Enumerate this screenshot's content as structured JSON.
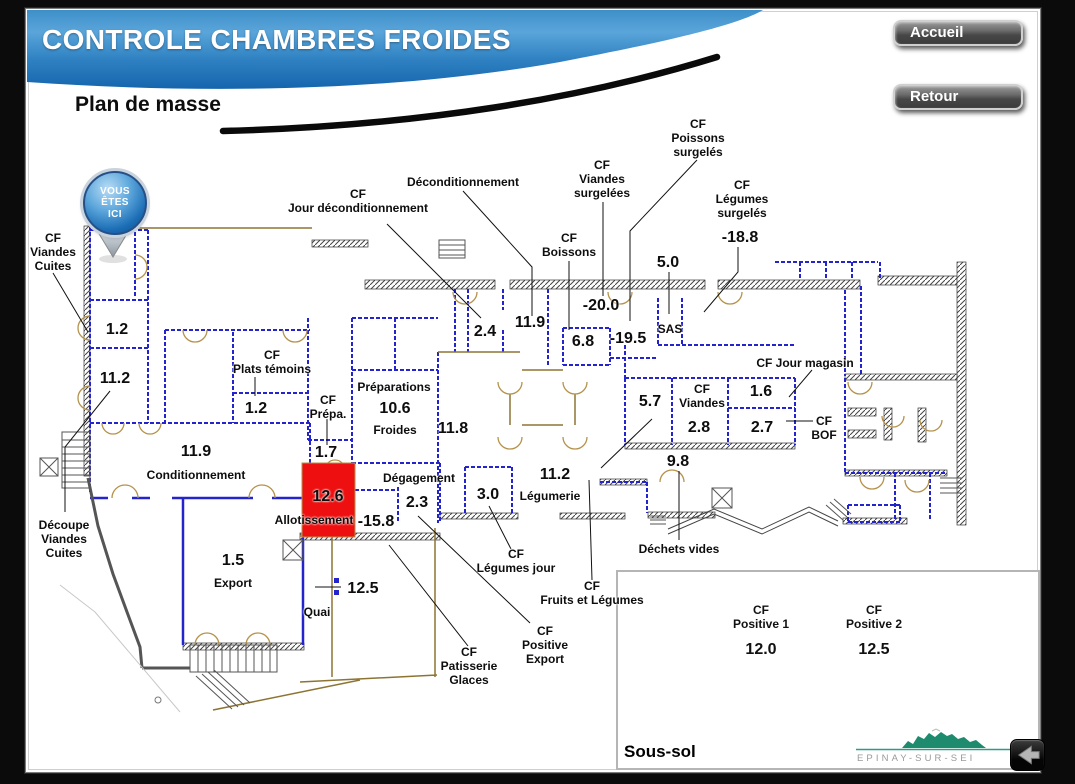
{
  "header": {
    "title": "CONTROLE CHAMBRES FROIDES",
    "subtitle": "Plan de masse"
  },
  "nav": {
    "accueil": "Accueil",
    "retour": "Retour"
  },
  "marker": {
    "lines": [
      "VOUS",
      "ÊTES",
      "ICI"
    ]
  },
  "plan": {
    "labels": [
      {
        "id": "cf-viandes-cuites",
        "kind": "name",
        "x": 53,
        "y": 252,
        "lines": [
          "CF",
          "Viandes",
          "Cuites"
        ]
      },
      {
        "id": "val-1-2-a",
        "kind": "value",
        "x": 117,
        "y": 330,
        "lines": [
          "1.2"
        ]
      },
      {
        "id": "val-11-2-a",
        "kind": "value",
        "x": 115,
        "y": 379,
        "lines": [
          "11.2"
        ]
      },
      {
        "id": "val-11-9-a",
        "kind": "value",
        "x": 196,
        "y": 452,
        "lines": [
          "11.9"
        ]
      },
      {
        "id": "conditionnement",
        "kind": "name",
        "x": 196,
        "y": 475,
        "lines": [
          "Conditionnement"
        ]
      },
      {
        "id": "cf-plats-temoins",
        "kind": "name",
        "x": 272,
        "y": 362,
        "lines": [
          "CF",
          "Plats témoins"
        ]
      },
      {
        "id": "val-1-2-b",
        "kind": "value",
        "x": 256,
        "y": 409,
        "lines": [
          "1.2"
        ]
      },
      {
        "id": "cf-prepa",
        "kind": "name",
        "x": 328,
        "y": 407,
        "lines": [
          "CF",
          "Prépa."
        ]
      },
      {
        "id": "val-1-7",
        "kind": "value",
        "x": 326,
        "y": 453,
        "lines": [
          "1.7"
        ]
      },
      {
        "id": "val-12-6",
        "kind": "value",
        "x": 328,
        "y": 497,
        "lines": [
          "12.6"
        ]
      },
      {
        "id": "allotissement",
        "kind": "name",
        "x": 314,
        "y": 520,
        "lines": [
          "Allotissement"
        ]
      },
      {
        "id": "preparations",
        "kind": "name",
        "x": 394,
        "y": 387,
        "lines": [
          "Préparations"
        ]
      },
      {
        "id": "val-10-6",
        "kind": "value",
        "x": 395,
        "y": 409,
        "lines": [
          "10.6"
        ]
      },
      {
        "id": "froides",
        "kind": "name",
        "x": 395,
        "y": 430,
        "lines": [
          "Froides"
        ]
      },
      {
        "id": "val-11-8",
        "kind": "value",
        "x": 453,
        "y": 429,
        "lines": [
          "11.8"
        ]
      },
      {
        "id": "degagement",
        "kind": "name",
        "x": 419,
        "y": 478,
        "lines": [
          "Dégagement"
        ]
      },
      {
        "id": "val-2-3",
        "kind": "value",
        "x": 417,
        "y": 503,
        "lines": [
          "2.3"
        ]
      },
      {
        "id": "val-neg-15-8",
        "kind": "value",
        "x": 376,
        "y": 522,
        "lines": [
          "-15.8"
        ]
      },
      {
        "id": "val-3-0",
        "kind": "value",
        "x": 488,
        "y": 495,
        "lines": [
          "3.0"
        ]
      },
      {
        "id": "val-11-2-b",
        "kind": "value",
        "x": 555,
        "y": 475,
        "lines": [
          "11.2"
        ]
      },
      {
        "id": "legumerie",
        "kind": "name",
        "x": 550,
        "y": 496,
        "lines": [
          "Légumerie"
        ]
      },
      {
        "id": "cf-legumes-jour",
        "kind": "name",
        "x": 516,
        "y": 561,
        "lines": [
          "CF",
          "Légumes jour"
        ]
      },
      {
        "id": "cf-fruits-et-legumes",
        "kind": "name",
        "x": 592,
        "y": 593,
        "lines": [
          "CF",
          "Fruits et Légumes"
        ]
      },
      {
        "id": "cf-positive-export",
        "kind": "name",
        "x": 545,
        "y": 645,
        "lines": [
          "CF",
          "Positive",
          "Export"
        ]
      },
      {
        "id": "cf-patisserie-glaces",
        "kind": "name",
        "x": 469,
        "y": 666,
        "lines": [
          "CF",
          "Patisserie",
          "Glaces"
        ]
      },
      {
        "id": "val-12-5",
        "kind": "value",
        "x": 363,
        "y": 589,
        "lines": [
          "12.5"
        ]
      },
      {
        "id": "quai",
        "kind": "name",
        "x": 317,
        "y": 612,
        "lines": [
          "Quai"
        ]
      },
      {
        "id": "val-1-5",
        "kind": "value",
        "x": 233,
        "y": 561,
        "lines": [
          "1.5"
        ]
      },
      {
        "id": "export",
        "kind": "name",
        "x": 233,
        "y": 583,
        "lines": [
          "Export"
        ]
      },
      {
        "id": "decoupe-viandes-cuites",
        "kind": "name",
        "x": 64,
        "y": 539,
        "lines": [
          "Découpe",
          "Viandes",
          "Cuites"
        ]
      },
      {
        "id": "deconditionnement",
        "kind": "name",
        "x": 463,
        "y": 182,
        "lines": [
          "Déconditionnement"
        ]
      },
      {
        "id": "cf-jour-deconditionnement",
        "kind": "name",
        "x": 358,
        "y": 201,
        "lines": [
          "CF",
          "Jour déconditionnement"
        ]
      },
      {
        "id": "val-2-4",
        "kind": "value",
        "x": 485,
        "y": 332,
        "lines": [
          "2.4"
        ]
      },
      {
        "id": "val-11-9-b",
        "kind": "value",
        "x": 530,
        "y": 323,
        "lines": [
          "11.9"
        ]
      },
      {
        "id": "cf-boissons",
        "kind": "name",
        "x": 569,
        "y": 245,
        "lines": [
          "CF",
          "Boissons"
        ]
      },
      {
        "id": "val-6-8",
        "kind": "value",
        "x": 583,
        "y": 342,
        "lines": [
          "6.8"
        ]
      },
      {
        "id": "cf-viandes-surgelees",
        "kind": "name",
        "x": 602,
        "y": 179,
        "lines": [
          "CF",
          "Viandes",
          "surgelées"
        ]
      },
      {
        "id": "val-neg-20-0",
        "kind": "value",
        "x": 601,
        "y": 306,
        "lines": [
          "-20.0"
        ]
      },
      {
        "id": "val-neg-19-5",
        "kind": "value",
        "x": 628,
        "y": 339,
        "lines": [
          "-19.5"
        ]
      },
      {
        "id": "sas",
        "kind": "name",
        "x": 670,
        "y": 329,
        "lines": [
          "SAS"
        ]
      },
      {
        "id": "val-5-0",
        "kind": "value",
        "x": 668,
        "y": 263,
        "lines": [
          "5.0"
        ]
      },
      {
        "id": "cf-poissons-surgeles",
        "kind": "name",
        "x": 698,
        "y": 138,
        "lines": [
          "CF",
          "Poissons",
          "surgelés"
        ]
      },
      {
        "id": "cf-legumes-surgeles",
        "kind": "name",
        "x": 742,
        "y": 199,
        "lines": [
          "CF",
          "Légumes",
          "surgelés"
        ]
      },
      {
        "id": "val-neg-18-8",
        "kind": "value",
        "x": 740,
        "y": 238,
        "lines": [
          "-18.8"
        ]
      },
      {
        "id": "val-5-7",
        "kind": "value",
        "x": 650,
        "y": 402,
        "lines": [
          "5.7"
        ]
      },
      {
        "id": "cf-viandes",
        "kind": "name",
        "x": 702,
        "y": 396,
        "lines": [
          "CF",
          "Viandes"
        ]
      },
      {
        "id": "val-2-8",
        "kind": "value",
        "x": 699,
        "y": 428,
        "lines": [
          "2.8"
        ]
      },
      {
        "id": "val-1-6",
        "kind": "value",
        "x": 761,
        "y": 392,
        "lines": [
          "1.6"
        ]
      },
      {
        "id": "val-2-7",
        "kind": "value",
        "x": 762,
        "y": 428,
        "lines": [
          "2.7"
        ]
      },
      {
        "id": "cf-jour-magasin",
        "kind": "name",
        "x": 805,
        "y": 363,
        "lines": [
          "CF Jour magasin"
        ]
      },
      {
        "id": "cf-bof",
        "kind": "name",
        "x": 824,
        "y": 428,
        "lines": [
          "CF",
          "BOF"
        ]
      },
      {
        "id": "val-9-8",
        "kind": "value",
        "x": 678,
        "y": 462,
        "lines": [
          "9.8"
        ]
      },
      {
        "id": "dechets-vides",
        "kind": "name",
        "x": 679,
        "y": 549,
        "lines": [
          "Déchets vides"
        ]
      }
    ]
  },
  "inset": {
    "title": "Sous-sol",
    "rooms": [
      {
        "name_lines": [
          "CF",
          "Positive 1"
        ],
        "value": "12.0",
        "x": 143
      },
      {
        "name_lines": [
          "CF",
          "Positive 2"
        ],
        "value": "12.5",
        "x": 256
      }
    ],
    "logo_text": "EPINAY-SUR-SEI"
  },
  "colors": {
    "banner_blue_top": "#4f9cd4",
    "banner_blue_bottom": "#1565ad",
    "wall_blue": "#2424cf",
    "door_tan": "#b5924a",
    "alert_room_red": "#ee1010",
    "logo_teal": "#1e8a6e"
  }
}
